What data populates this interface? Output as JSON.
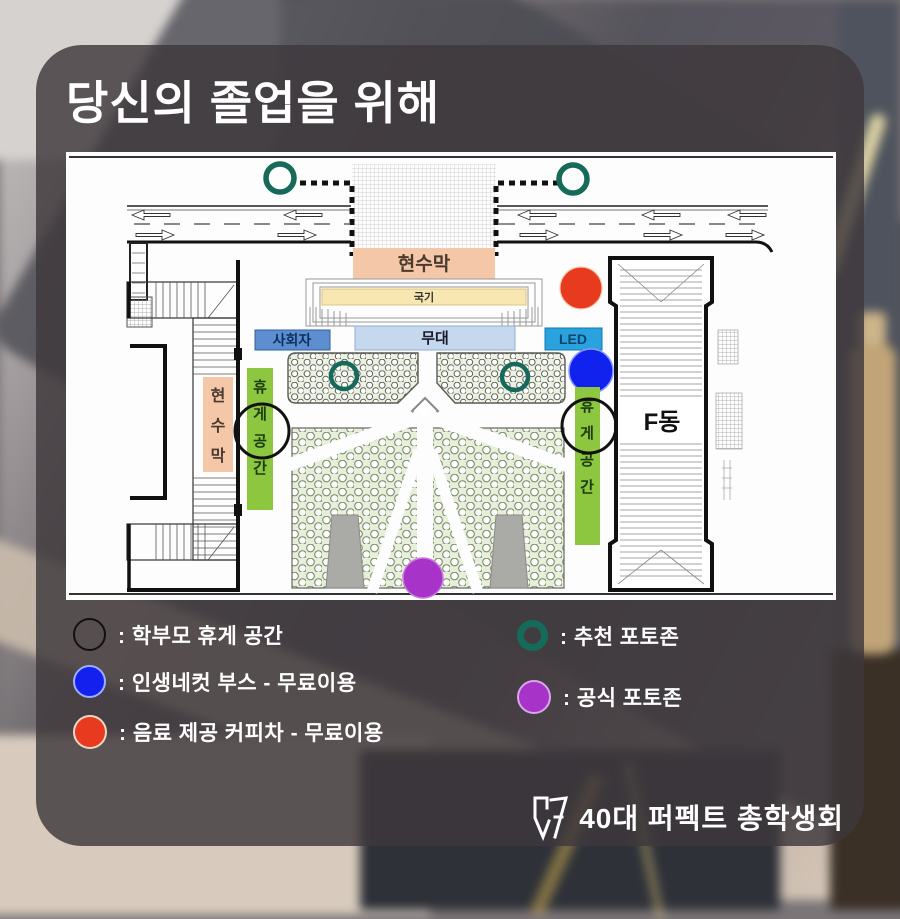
{
  "title": "당신의 졸업을 위해",
  "map": {
    "banner_top": "현수막",
    "flag": "국기",
    "mc": "사회자",
    "stage": "무대",
    "led": "LED",
    "banner_left": "현수막",
    "rest_area_left": "휴게공간",
    "rest_area_right": "휴게공간",
    "building_f": "F동"
  },
  "legend": {
    "left": [
      {
        "label": ": 학부모 휴게 공간",
        "marker": "black-ring",
        "color": "#111111"
      },
      {
        "label": ": 인생네컷 부스 - 무료이용",
        "marker": "blue-dot",
        "color": "#1420ee"
      },
      {
        "label": ": 음료 제공 커피차 - 무료이용",
        "marker": "red-dot",
        "color": "#e83a1e"
      }
    ],
    "right": [
      {
        "label": ": 추천 포토존",
        "marker": "teal-ring",
        "color": "#156a59"
      },
      {
        "label": ": 공식 포토존",
        "marker": "purple-dot",
        "color": "#a833c9"
      }
    ]
  },
  "footer": {
    "org": "40대 퍼펙트 총학생회"
  },
  "colors": {
    "banner": "#f4c7a9",
    "flag_bar": "#f9e7b2",
    "mc_box": "#5d8fd0",
    "stage_box": "#c5d8ed",
    "led_box": "#29a2dd",
    "rest_bar": "#8cc73f",
    "coffee_truck": "#e73a1e",
    "photo_booth": "#1222ee",
    "official_photozone": "#a833c9",
    "recommended_photozone": "#156a59",
    "card_overlay": "#3e383c"
  }
}
